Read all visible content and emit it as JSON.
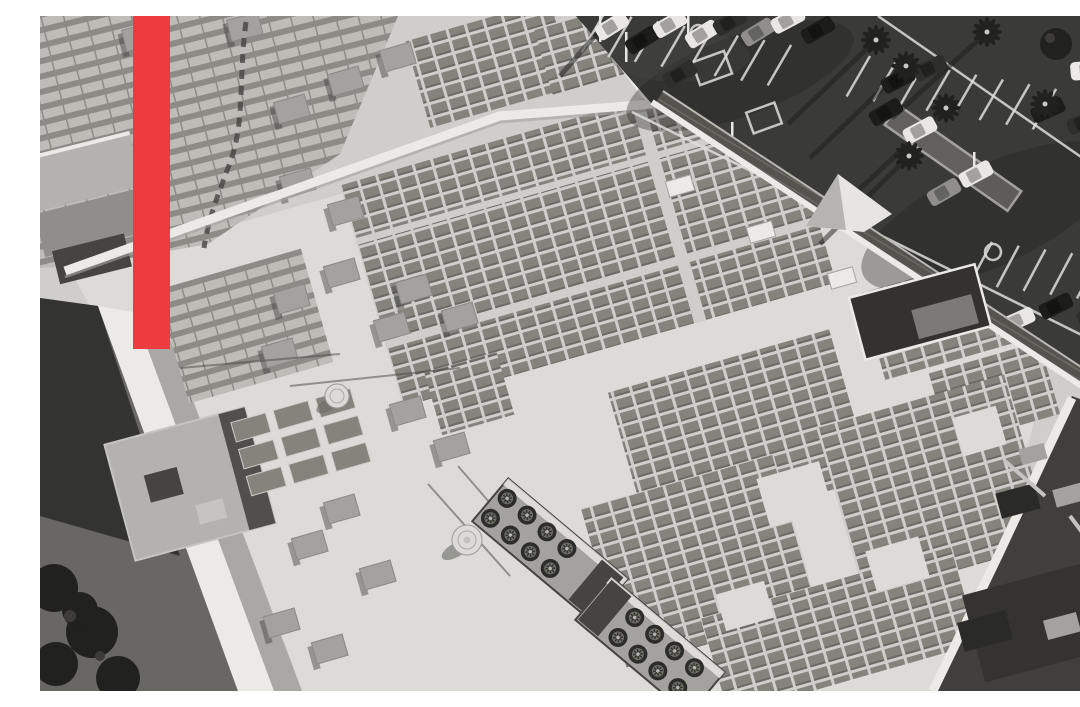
{
  "meta": {
    "type": "featured-hero-photograph",
    "alt": "Black and white aerial photograph of a large commercial big-box building rooftop covered with rows of solar panel arrays, rooftop HVAC units with circular fans, skylights and vents; a dark parking lot with cars, palm trees and painted stall lines fills the upper right; a solid red vertical accent bar is overlaid near the upper left corner.",
    "visible_text": "none"
  },
  "overlay": {
    "accent_bar": {
      "shape": "vertical-rectangle",
      "color_ref": "accent_red"
    }
  },
  "colors": {
    "accent_red": "#ee3b3f",
    "roof_light": "#cfcecb",
    "roof_sun": "#dcdbd7",
    "roof_mid": "#b3b2ae",
    "roof_shade": "#a5a4a0",
    "parapet_white": "#eceae6",
    "panel_dark": "#84837c",
    "panel_gap": "#cfcecb",
    "panel_light": "#bdbcb6",
    "panel_light_gap": "#8c8b85",
    "asphalt": "#3a3a38",
    "asphalt_shadow": "#222220",
    "alley_gray": "#686764",
    "wall_shadow": "#514f4c",
    "equipment_gray": "#a3a29e",
    "equipment_dark": "#454441",
    "tree_dark": "#21211f",
    "marking_white": "#dededa",
    "lower_roof_dark": "#413f3d",
    "fan_dark": "#2c2c2a"
  }
}
